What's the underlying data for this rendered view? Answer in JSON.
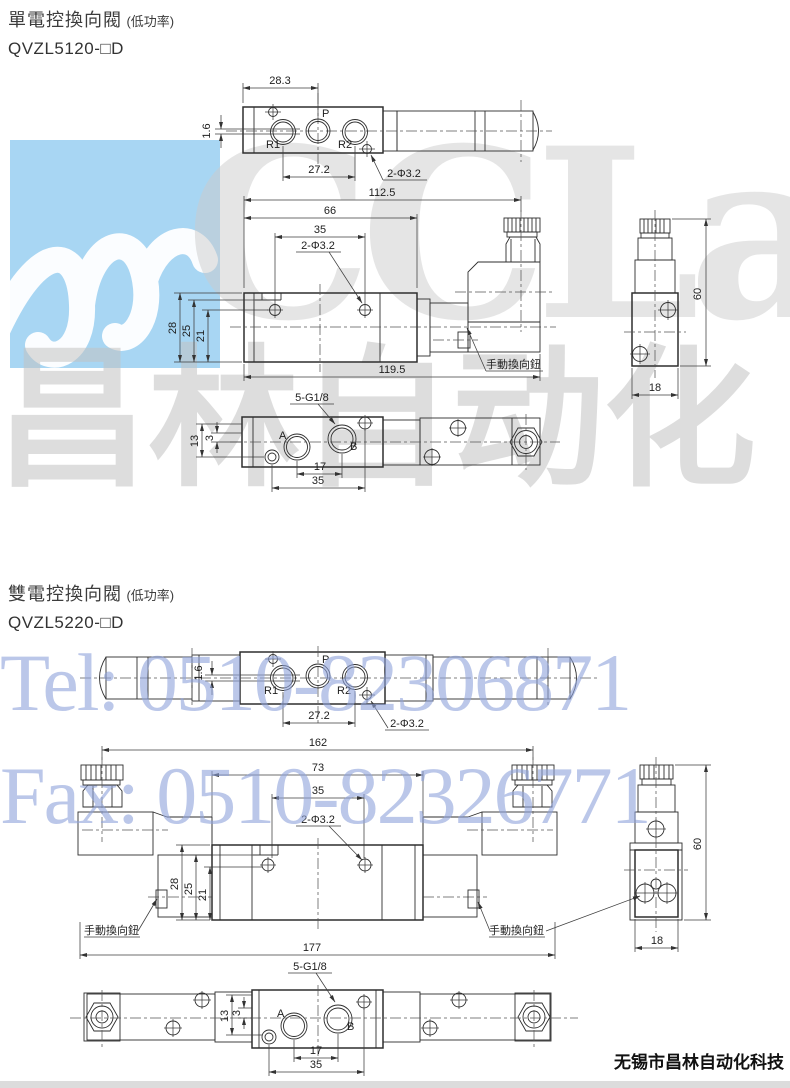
{
  "watermark": {
    "brand": "CCLair",
    "brand_cn": "昌林自动化",
    "tel": "Tel: 0510-82306871",
    "fax": "Fax: 0510-82326771",
    "logo_color": "#a8d6f3",
    "gray_color": "#c9c9c9",
    "blue_text_color": "#8fa3db"
  },
  "footer": {
    "company": "无锡市昌林自动化科技"
  },
  "sections": [
    {
      "title": "單電控換向閥",
      "note": "(低功率)",
      "model": "QVZL5120-□D",
      "top": {
        "d283": "28.3",
        "d16": "1.6",
        "d272": "27.2",
        "hole": "2-Φ3.2",
        "r1": "R1",
        "p": "P",
        "r2": "R2"
      },
      "front": {
        "d1125": "112.5",
        "d66": "66",
        "d35": "35",
        "hole": "2-Φ3.2",
        "d28": "28",
        "d25": "25",
        "d21": "21",
        "d1195": "119.5",
        "manual": "手動換向鈕"
      },
      "side": {
        "d60": "60",
        "d18": "18"
      },
      "bottom": {
        "thread": "5-G1/8",
        "d13": "13",
        "d3": "3",
        "a": "A",
        "b": "B",
        "d17": "17",
        "d35": "35"
      }
    },
    {
      "title": "雙電控換向閥",
      "note": "(低功率)",
      "model": "QVZL5220-□D",
      "top": {
        "d16": "1.6",
        "d272": "27.2",
        "hole": "2-Φ3.2",
        "r1": "R1",
        "p": "P",
        "r2": "R2"
      },
      "front": {
        "d162": "162",
        "d73": "73",
        "d35": "35",
        "hole": "2-Φ3.2",
        "d28": "28",
        "d25": "25",
        "d21": "21",
        "d177": "177",
        "manual_left": "手動換向鈕",
        "manual_right": "手動換向鈕"
      },
      "side": {
        "d60": "60",
        "d18": "18"
      },
      "bottom": {
        "thread": "5-G1/8",
        "d13": "13",
        "d3": "3",
        "a": "A",
        "b": "B",
        "d17": "17",
        "d35": "35"
      }
    }
  ]
}
